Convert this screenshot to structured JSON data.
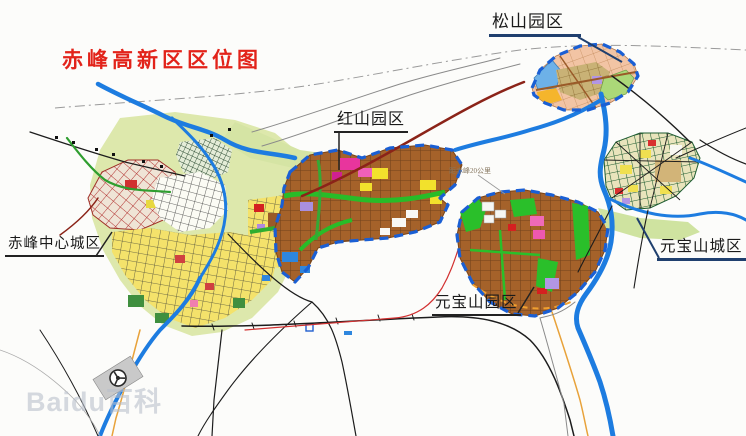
{
  "title": {
    "text": "赤峰高新区区位图"
  },
  "map_labels": {
    "songshan_park": "松山园区",
    "hongshan_park": "红山园区",
    "chifeng_central_city": "赤峰中心城区",
    "yuanbaoshan_park": "元宝山园区",
    "yuanbaoshan_city": "元宝山城区",
    "distance_note": "距赤峰20公里"
  },
  "watermark": "Baidu百科",
  "colors": {
    "title_red": "#e2231a",
    "river_blue": "#1d7ce0",
    "park_border_blue": "#1a5fd4",
    "industrial_block_brown": "#a5622a",
    "greenway_green": "#28bc28",
    "highway_maroon": "#8b2318",
    "railway_black": "#1c1c1c",
    "secondary_road_orange": "#e8a23a",
    "farmland_green": "#dde8ac",
    "label_underline_navy": "#1f3f6e"
  }
}
